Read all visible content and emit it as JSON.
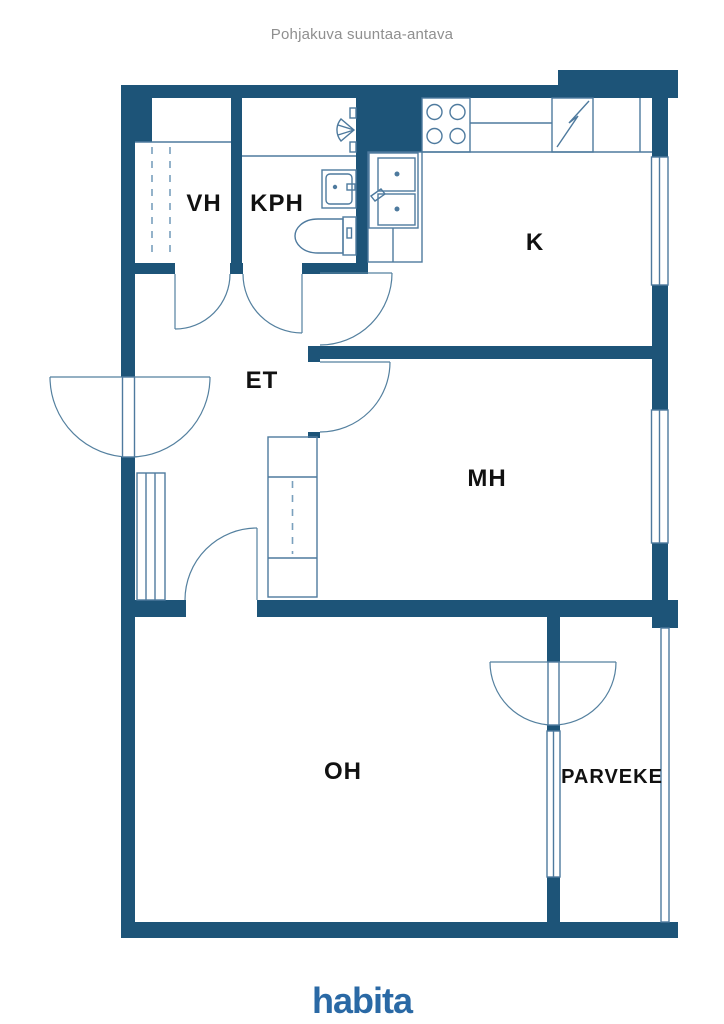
{
  "header": {
    "title": "Pohjakuva suuntaa-antava"
  },
  "floorplan": {
    "type": "apartment-floor-plan",
    "rooms": [
      {
        "id": "vh",
        "label": "VH"
      },
      {
        "id": "kph",
        "label": "KPH"
      },
      {
        "id": "k",
        "label": "K"
      },
      {
        "id": "et",
        "label": "ET"
      },
      {
        "id": "mh",
        "label": "MH"
      },
      {
        "id": "oh",
        "label": "OH"
      },
      {
        "id": "parveke",
        "label": "PARVEKE"
      }
    ],
    "colors": {
      "wall": "#1d5478",
      "fixture_line": "#4e7a9e",
      "dashed_line": "#7aa0bd",
      "label": "#111111",
      "title": "#8f8f8f",
      "logo": "#2a69a5"
    }
  },
  "footer": {
    "logo_text": "habita"
  }
}
